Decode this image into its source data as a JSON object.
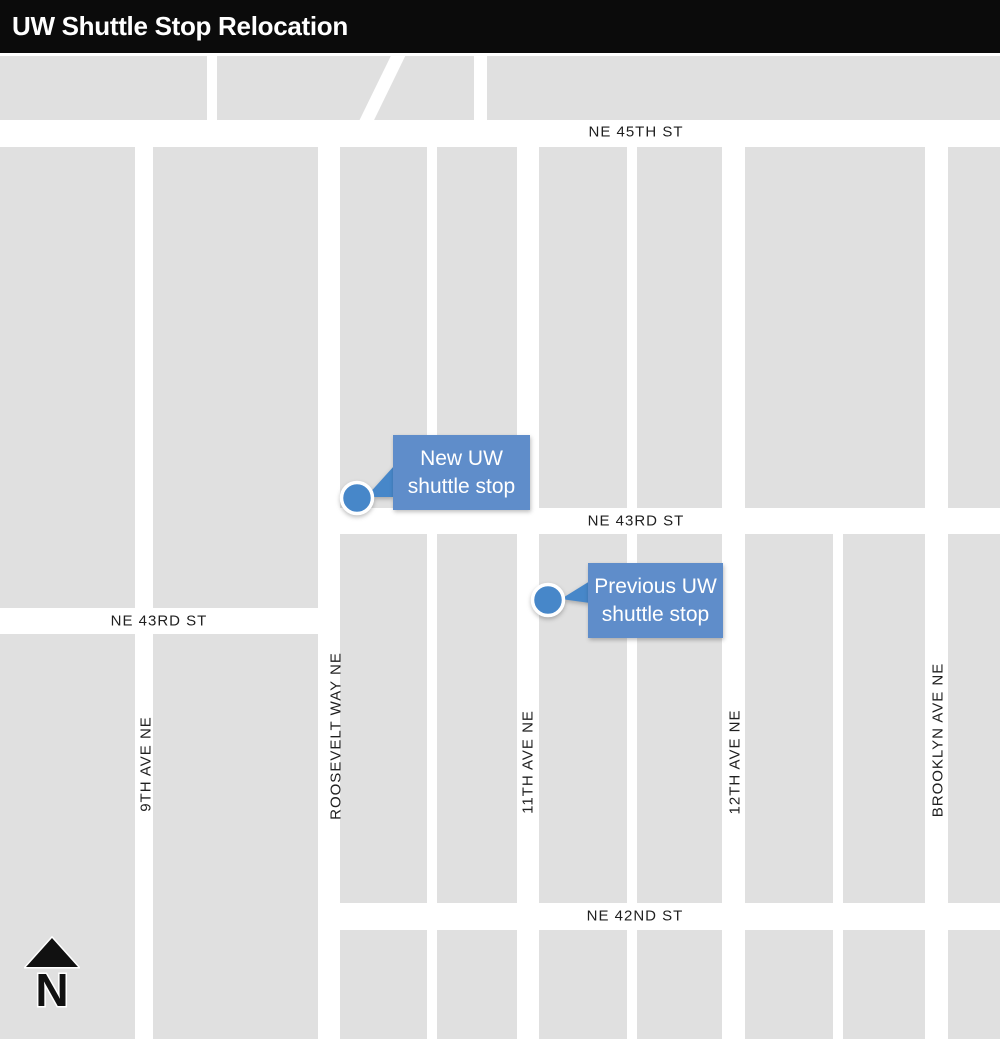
{
  "title": "UW Shuttle Stop Relocation",
  "map": {
    "colors": {
      "header-bg": "#0b0b0b",
      "header-text": "#ffffff",
      "block": "#e0e0e0",
      "street": "#ffffff",
      "label-text": "#1f1f1f",
      "callout-box": "#5f8dca",
      "callout-dot": "#4787c9",
      "callout-text": "#ffffff",
      "north-arrow": "#111111"
    },
    "streets": {
      "ne_45th": "NE 45TH ST",
      "ne_43rd_east": "NE 43RD ST",
      "ne_43rd_west": "NE 43RD ST",
      "ne_42nd": "NE 42ND ST",
      "ave_9th": "9TH AVE NE",
      "roosevelt": "ROOSEVELT WAY NE",
      "ave_11th": "11TH AVE NE",
      "ave_12th": "12TH AVE NE",
      "brooklyn": "BROOKLYN AVE NE"
    },
    "callouts": {
      "new_stop": {
        "line1": "New UW",
        "line2": "shuttle stop"
      },
      "previous_stop": {
        "line1": "Previous UW",
        "line2": "shuttle stop"
      }
    },
    "north_arrow": {
      "label": "N"
    }
  }
}
